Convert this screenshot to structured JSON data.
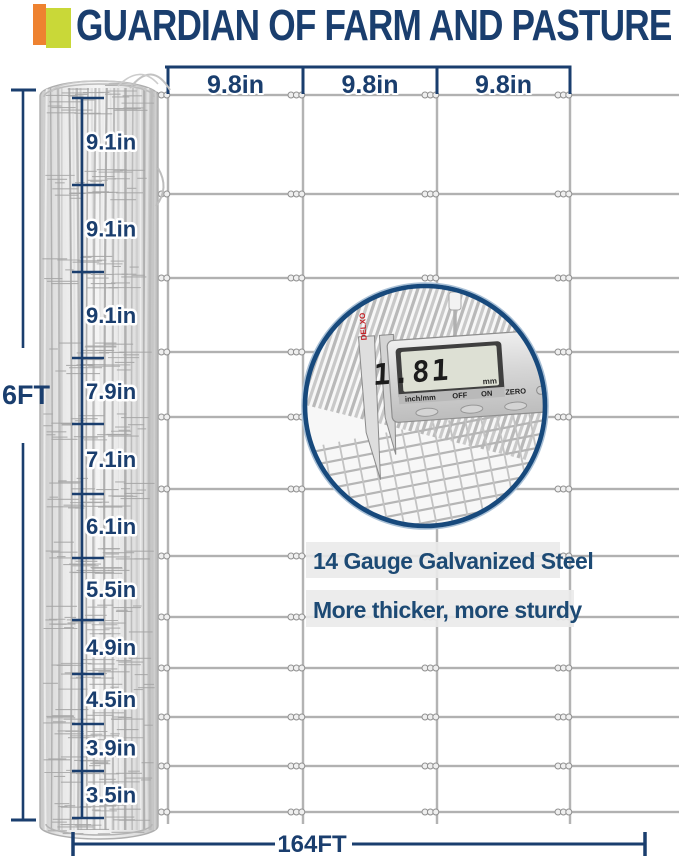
{
  "header": {
    "title": "GUARDIAN OF FARM AND PASTURE"
  },
  "colors": {
    "navy": "#1a3e6e",
    "caption_navy": "#1d4a74",
    "accent_orange": "#ee8230",
    "accent_green": "#c9d838",
    "wire_gray": "#b3b3b3",
    "caliper_brand_red": "#c42127"
  },
  "roll_dimension": {
    "total_height_label": "6FT",
    "segments": [
      "9.1in",
      "9.1in",
      "9.1in",
      "7.9in",
      "7.1in",
      "6.1in",
      "5.5in",
      "4.9in",
      "4.5in",
      "3.9in",
      "3.5in"
    ]
  },
  "mesh": {
    "column_spacing_labels": [
      "9.8in",
      "9.8in",
      "9.8in"
    ],
    "total_width_label": "164FT"
  },
  "inset": {
    "caliper": {
      "brand": "DELXO",
      "display_value": "1.81",
      "display_unit": "mm",
      "button_labels": [
        "inch/mm",
        "OFF",
        "ON",
        "ZERO"
      ]
    },
    "caption_line1": "14 Gauge Galvanized Steel",
    "caption_line2": "More thicker, more sturdy"
  }
}
